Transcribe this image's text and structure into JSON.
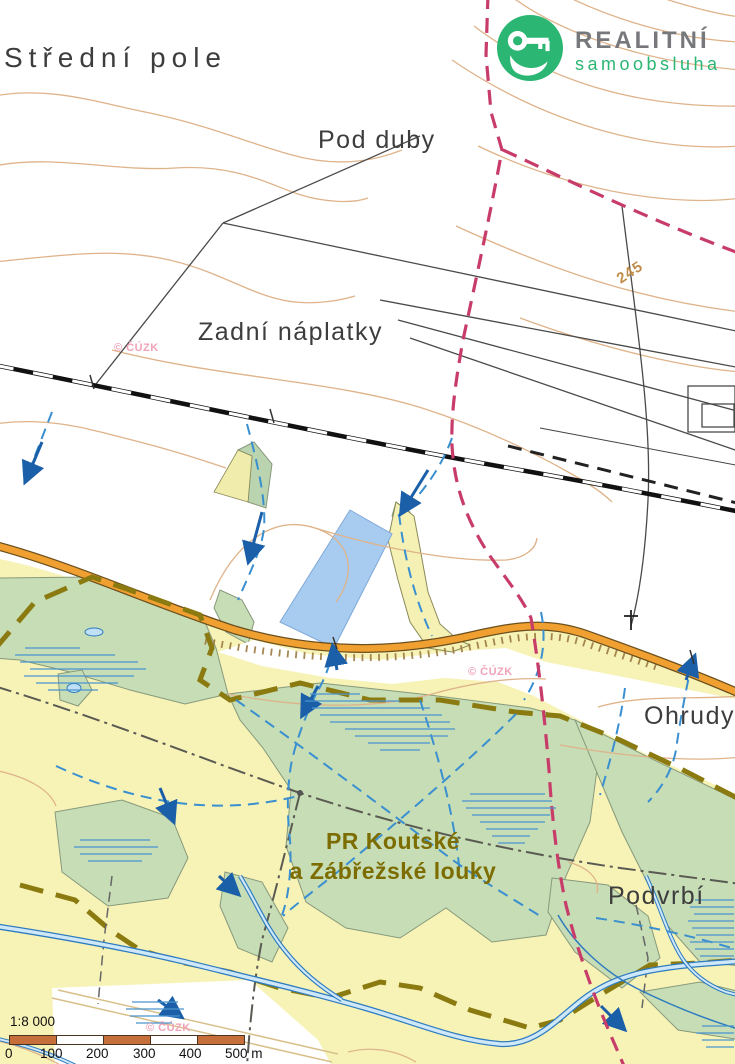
{
  "logo": {
    "brand": "REALITNÍ",
    "subtitle": "samoobsluha",
    "icon": "key-in-hand",
    "circle_color": "#2bb673",
    "brand_color": "#77787b"
  },
  "labels": {
    "stredni_pole": "Střední pole",
    "pod_duby": "Pod duby",
    "zadni_naplatky": "Zadní náplatky",
    "ohrudy": "Ohrudy",
    "podvrbi": "Podvrbí",
    "reserve_line1": "PR Koutské",
    "reserve_line2": "a Zábřežské louky",
    "contour_245": "245"
  },
  "watermark": "© ČÚZK",
  "scale": {
    "ratio": "1:8 000",
    "ticks": [
      "0",
      "100",
      "200",
      "300",
      "400"
    ],
    "end_label": "500 m",
    "bar_color": "#c76f3b"
  },
  "map_colors": {
    "field_yellow": "#f7f3b7",
    "meadow_green": "#c6ddb6",
    "water_blue": "#a8ccf0",
    "river_blue": "#2e7bbf",
    "road_orange": "#f0a030",
    "trail_pink": "#c83c6a",
    "reserve_boundary_olive": "#8a7a10",
    "contour_tan": "#dfb38a",
    "railway_black": "#111111"
  }
}
